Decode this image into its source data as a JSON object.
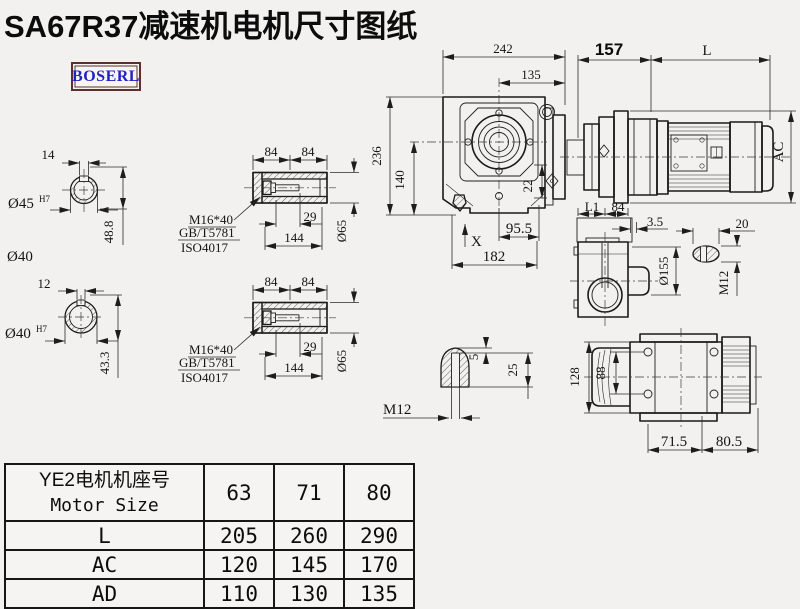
{
  "title": "SA67R37减速机电机尺寸图纸",
  "logo": "BOSERL",
  "drawing": {
    "shaft_solid": {
      "key_width": "14",
      "bore_dia": "Ø45",
      "fit": "H7",
      "depth": "48.8",
      "od_label": "Ø40"
    },
    "shaft_hollow": {
      "key_width": "12",
      "bore_dia": "Ø40",
      "fit": "H7",
      "depth": "43.3"
    },
    "bushing": {
      "len_a": "84",
      "len_b": "84",
      "bolt": "M16*40",
      "std_gb": "GB/T5781",
      "std_iso": "ISO4017",
      "stud_len": "29",
      "total_len": "144",
      "od": "Ø65"
    },
    "main_view": {
      "width_242": "242",
      "width_135": "135",
      "width_157": "157",
      "motor_len": "L",
      "height_236": "236",
      "height_140": "140",
      "dim_22": "22",
      "dim_95_5": "95.5",
      "dim_182": "182",
      "mark_x": "X",
      "motor_dia": "AC"
    },
    "top_view": {
      "dim_l1": "L1",
      "dim_84": "84",
      "dim_3_5": "3.5",
      "dim_20": "20",
      "flange_dia": "Ø155",
      "thread": "M12"
    },
    "key_detail": {
      "dim_5": "5",
      "dim_25": "25",
      "thread": "M12"
    },
    "bottom_view": {
      "dim_128": "128",
      "dim_88": "88",
      "dim_71_5": "71.5",
      "dim_80_5": "80.5"
    }
  },
  "table": {
    "header_cn": "YE2电机机座号",
    "header_en": "Motor Size",
    "sizes": [
      "63",
      "71",
      "80"
    ],
    "rows": [
      {
        "label": "L",
        "values": [
          "205",
          "260",
          "290"
        ]
      },
      {
        "label": "AC",
        "values": [
          "120",
          "145",
          "170"
        ]
      },
      {
        "label": "AD",
        "values": [
          "110",
          "130",
          "135"
        ]
      }
    ]
  }
}
